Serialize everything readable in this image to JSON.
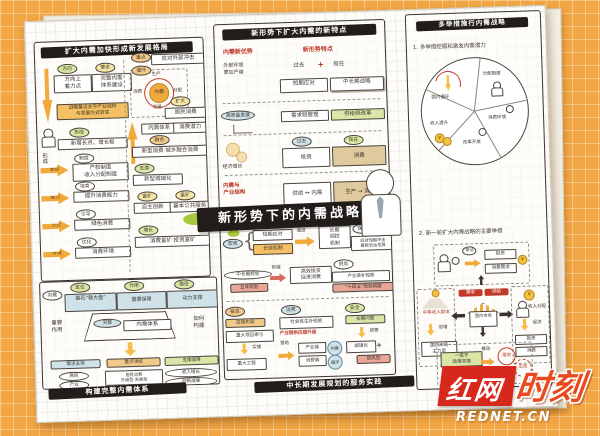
{
  "colors": {
    "bg": "#F2A644",
    "paper": "#FDFCF8",
    "banner": "#221D1A",
    "accent_orange": "#F2A93C",
    "accent_green": "#D9E6A8",
    "accent_blue": "#CFE2EA",
    "accent_red": "#C0392B",
    "watermark_red": "#D7281D",
    "splash_green": "#A9C63F"
  },
  "icons": {
    "plus": "+",
    "arrow_right": "→",
    "lr": "↔",
    "brace": "{",
    "yen": "¥",
    "up": "↑",
    "down": "↓"
  },
  "watermark": {
    "brand_left": "红网",
    "brand_right": "时刻",
    "domain": "REDNET.CN"
  },
  "center": {
    "title": "新形势下的内需战略"
  },
  "p1": {
    "title": "扩大内需加快形成新发展格局",
    "pair1_bubble": "方向",
    "pair1_box": "方向上\n着力点",
    "pair2_bubble": "要求",
    "pair2_box": "完整内需\n体系建设",
    "note": "战略基点关乎产业结构\n与发展方式转变",
    "side_label": "形成",
    "form_bubble": "形成",
    "form_box": "新增长点、增长极",
    "rows": [
      {
        "arrow": "基点",
        "bubble": "制度",
        "box": "产权制度\n收入分配制度"
      },
      {
        "arrow": "能力",
        "bubble": "培育",
        "box": "提升消费能力"
      },
      {
        "arrow": "方式",
        "bubble": "引导",
        "box": "绿色消费"
      },
      {
        "arrow": "环境",
        "bubble": "优化",
        "box": "消费环境"
      }
    ],
    "flow": {
      "bubble": "循环",
      "center": "内需",
      "n": "生产",
      "e": "分配",
      "s": "流通",
      "w": "消费"
    },
    "r1_bubble": "重点",
    "r1_box": "应对外部冲击",
    "r2_bubble": "扩大",
    "r2_box": "居民消费",
    "r3_box1": "内需体系",
    "r3_box2": "消费潜力",
    "r4_bubble": "融合",
    "r4_box": "新型消费·城乡融合消费",
    "r5_bubble": "支撑",
    "r5_box": "新型城镇化",
    "r6_bubble1": "富矿",
    "r6_box1": "自主创新",
    "r6_bubble2": "富矿",
    "r6_box2": "基本公共服务",
    "r7_bubble": "增长",
    "r7_box": "消费富矿·投资富矿"
  },
  "p2": {
    "title": "新形势下扩大内需的新特点",
    "head_left": "内需新优势",
    "head_right": "新形势特点",
    "sub_left": "外部环境\n更加严峻",
    "past": "过去",
    "now": "现在",
    "box_short": "短期应对",
    "box_long": "中长期战略",
    "row2_label": "高质量发展",
    "row2_box1": "需求侧管理",
    "row2_box2": "供给侧改革",
    "row3_label": "经济增长",
    "row3_bubble1": "过去",
    "row3_box1": "投资",
    "row3_bubble2": "现在",
    "row3_box2": "消费",
    "row4_label": "内需与\n产业结构",
    "row4_box1": "供给 ↔ 内需",
    "row4_box2": "生产 → 消费"
  },
  "p3": {
    "title": "多举措施行内需战略",
    "item1": "1. 多举措挖掘和激发内需潜力",
    "pie": [
      "国内循环",
      "分配制度",
      "消费环境",
      "改革开放",
      "收入提升"
    ],
    "item2": "2. 新一轮扩大内需战略的主要举措",
    "top_arrow": "带动",
    "top_box1": "投资",
    "top_box2": "消费需求",
    "left_title": "中等收入群体",
    "left_arrow": "倍增",
    "left_box": "国内市场\n主力军",
    "chip1": "需求",
    "chip2": "供给",
    "shop": "国内市场",
    "right_title": "收入分配",
    "right_arrow": "促进",
    "right_box1": "投资",
    "right_box2": "消费",
    "bot_box": "一揽子\n政策举措",
    "bot_arrow": "推动",
    "bot_c1": "落地",
    "bot_c2": "见效"
  },
  "p4": {
    "banner": "构建完整内需体系",
    "lead": "内需",
    "top": [
      {
        "bubble": "定位",
        "box": "基石“稳大盘”"
      },
      {
        "bubble": "作用",
        "box": "重要保障"
      },
      {
        "bubble": "路径",
        "box": "动力支撑"
      }
    ],
    "left_note": "重要\n作用",
    "right_note": "如何\n构建",
    "trap_ellipse": "完整",
    "trap_box": "内需体系",
    "h1": "需求主体",
    "h2": "重点领域",
    "h3": "支撑保障",
    "c1": [
      "居民",
      "产业",
      "政府"
    ],
    "c1_note": "三大主体",
    "c2": [
      "居民消费\n升级型·发展型",
      "产业投资\n一流企业·专精特新",
      "城乡建设\n区域布局·新型基建"
    ],
    "c3": [
      "收入增长",
      "创新成果",
      "一带一路市场",
      "高标准市场体系"
    ],
    "c3_note": "制度保障"
  },
  "p5": {
    "banner": "中长期发展规划的服务实践",
    "r1_bubble": "宏观",
    "r1_box1": "短期应对",
    "r1_box2": "长效机制",
    "r1_arrow": "递进",
    "r1_big": "长期\n调控\n机制",
    "r1_note_bubble": "保障",
    "r1_note": "应对短期冲击\n着眼长远发展",
    "r2_ellipse": "中长期规划",
    "r2_chip": "五年规划",
    "r2_arrow": "衔接",
    "r2_box": "高效投资\n促进消费",
    "r2_bubble": "例如",
    "r2_eg": "产业链补短板",
    "r2_hl": "“十四五”规划纲要",
    "c1_bubble": "投资",
    "c1_chip": "区域布局",
    "c1_box": "重大项目牵引",
    "c1_arrow": "实施",
    "c1_out": "重大工程",
    "c2_bubble": "消费",
    "c2_box": "社会民生补短板",
    "c2_red": "产业链供应链升级",
    "c2_arrow": "落地",
    "c2_box1": "产业端",
    "c2_box2": "消费端",
    "c2_c1": "内需",
    "c2_c2": "循环",
    "c3_bubble": "安全",
    "c3_chip": "长期问题",
    "c3_arrow": "统筹",
    "c3_box": "城镇化",
    "c3_plus": "+",
    "c3_hl": "防风险"
  }
}
